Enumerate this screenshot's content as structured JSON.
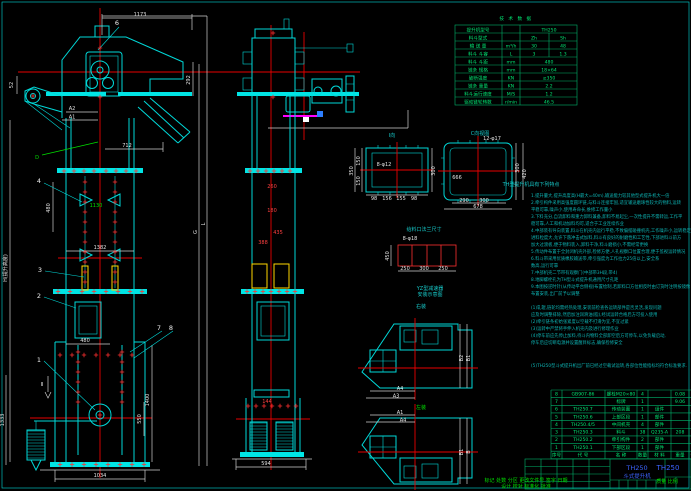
{
  "tech": {
    "title": "技 术 数 据",
    "rows": [
      {
        "label": "提升机型号",
        "unit": "",
        "v1": "TH250",
        "v2": "",
        "span": true
      },
      {
        "label": "料斗型式",
        "unit": "",
        "v1": "Zh",
        "v2": "Sh",
        "span": false
      },
      {
        "label": "输 送 量",
        "unit": "m³/h",
        "v1": "30",
        "v2": "48",
        "span": false
      },
      {
        "label": "料斗 斗容",
        "unit": "L",
        "v1": "3",
        "v2": "1.3",
        "span": false
      },
      {
        "label": "料斗 斗距",
        "unit": "mm",
        "v1": "480",
        "v2": "",
        "span": true
      },
      {
        "label": "链条 规格",
        "unit": "mm",
        "v1": "18×64",
        "v2": "",
        "span": true
      },
      {
        "label": "破断强度",
        "unit": "KN",
        "v1": "≥350",
        "v2": "",
        "span": true
      },
      {
        "label": "链条 重量",
        "unit": "KN",
        "v1": "2.2",
        "v2": "",
        "span": true
      },
      {
        "label": "料斗运行速度",
        "unit": "M/S",
        "v1": "1.2",
        "v2": "",
        "span": true
      },
      {
        "label": "驱动链轮转数",
        "unit": "r/min",
        "v1": "46.5",
        "v2": "",
        "span": true
      }
    ]
  },
  "features": {
    "title": "TH型提升机具有下列特点",
    "lines": [
      "1.提升量大,提升高度高(H最大=40m),输送能力较其他型式提升机大一倍",
      "2.牵引构件采用高强度圆环链,与料斗连接牢固,适宜输送磨琢性较大的物料,运转",
      "  平稳可靠,噪声小,使用寿命长,维修工作量小",
      "3.下料充分,自流卸料和重力卸料兼备,卸料不易起尘,一次性提升不需转运,工作平",
      "  稳可靠,人工和机动加料均可,适合于工业连续作业",
      "4.中部装有导向装置,料斗在机壳内运行平稳,不致偏摆碰撞机壳,工作噪声小,运转稳定,",
      "  进料粒度大,允许下落冲击式加料,料斗有良好的耐磨性和工艺性,下部进料斗前方",
      "  加大过渡板,便于物料装入,卸料干净,料斗磨损小,不需经常更换",
      "5.传动件布置于全封闭机壳外部,检修方便,人孔视察口位置合理,便于监视运转情况",
      "6.料斗带采用优质橡胶输送带,牵引强度为工作拉力25倍以上,安全系",
      "  数高,运行可靠",
      "7.中部机壳二节带有观察门(中部带3H段,带4)",
      "8.地脚螺栓孔为TH型斗式提升机通用尺寸孔距",
      "9.本图按逆时针(从传动平台侧视)布置绘制,若卸料口方位相反时由订货时注明按镜像",
      "  布置安装,出厂前予以调整",
      "(1)轧辊,链轮均需经热处理,安装前检查各运转部件是否灵活,发现问题",
      "  应及时调整排除,然后加注润滑油(脂),经试运转合格后方可投入使用",
      "(2)牵引链条初始张紧度以空载不打滑为宜,不宜过紧",
      "(3)运转中严禁将手伸入机壳内及进行修理作业",
      "(4)停车前应先停止加料,待斗内物料全部卸空后方可停车,以免负载启动,",
      "  停车后应切断电源并设置醒目标志,确保检修安全",
      "(5)TH250型斗式提升机出厂前已经过空载试运转,各部位性能指标均符合标准要求."
    ]
  },
  "bom": {
    "header": [
      "序号",
      "代 号",
      "名 称",
      "数量",
      "材 料",
      "重量",
      "备注"
    ],
    "rows": [
      [
        "8",
        "GB907-86",
        "螺栓M20×80",
        "4",
        "",
        "0.08",
        ""
      ],
      [
        "7",
        "",
        "标牌",
        "1",
        "",
        "9.06",
        ""
      ],
      [
        "6",
        "TH250.7",
        "传动装置",
        "1",
        "组件",
        "",
        ""
      ],
      [
        "5",
        "TH250.6",
        "上部区段",
        "1",
        "部件",
        "",
        ""
      ],
      [
        "4",
        "TH250.4/5",
        "中间机壳",
        "4",
        "部件",
        "",
        ""
      ],
      [
        "3",
        "TH250.3",
        "料斗",
        "38",
        "Q235-A",
        "208",
        ""
      ],
      [
        "2",
        "TH250.2",
        "牵引构件",
        "2",
        "部件",
        "",
        ""
      ],
      [
        "1",
        "TH250.1",
        "下部区段",
        "1",
        "部件",
        "",
        ""
      ]
    ]
  },
  "tb": {
    "product_model": "TH250",
    "product_name": "斗式提升机",
    "drawing_no": "TH250",
    "sig_row1": "标记 处数 分区 更改文件号 签字 日期",
    "sig_row2": "设计  校对  标准化  批准",
    "right_small": "质量 比例"
  },
  "d": {
    "top1173": "1173",
    "chute712": "712",
    "dim52": "52",
    "dim292": "292",
    "a2": "A2",
    "a1": "A1",
    "green1130": "1130",
    "mid1382": "1382",
    "left480": "480",
    "boot480": "480",
    "v1400": "1400",
    "v550": "550",
    "v1333": "1333",
    "base1034": "1034",
    "s260": "260",
    "s180": "180",
    "s435": "435",
    "s388": "388",
    "s144": "144",
    "s594": "594",
    "f1_holes": "8-φ12",
    "f1_350": "350",
    "f1_150a": "150",
    "f1_150b": "150",
    "f1_300": "300",
    "f1_b1": "98",
    "f1_b2": "156",
    "f1_b3": "155",
    "f1_b4": "98",
    "f2_holes": "12-φ17",
    "f2_666": "666",
    "f2_290": "290",
    "f2_300": "300",
    "f2_678": "678",
    "f2_r300": "300",
    "f2_420": "420",
    "feed_holes": "8-φ18",
    "feed_450": "450",
    "feed_b1": "250",
    "feed_b2": "300",
    "feed_b3": "250",
    "p1a4": "A4",
    "p1a3": "A3",
    "p1b2": "B2",
    "p1b1": "B1",
    "p2a1": "A1",
    "p2a4": "A4",
    "p2b1": "B1",
    "p2b": "B"
  },
  "lbl": {
    "b1": "1",
    "b2": "2",
    "b3": "3",
    "b4": "4",
    "b6": "6",
    "b7": "7",
    "b8": "8",
    "d_balloon": "D",
    "sec2": "Ⅱ",
    "g": "G",
    "l": "L",
    "h": "H(提升高度)",
    "i_view": "I向",
    "c_view": "C向视图",
    "feed_title": "给料口法兰尺寸",
    "drive1": "YZ型减速器",
    "drive2": "安装示意图",
    "right_mount": "右装",
    "left_mount": "左装"
  }
}
